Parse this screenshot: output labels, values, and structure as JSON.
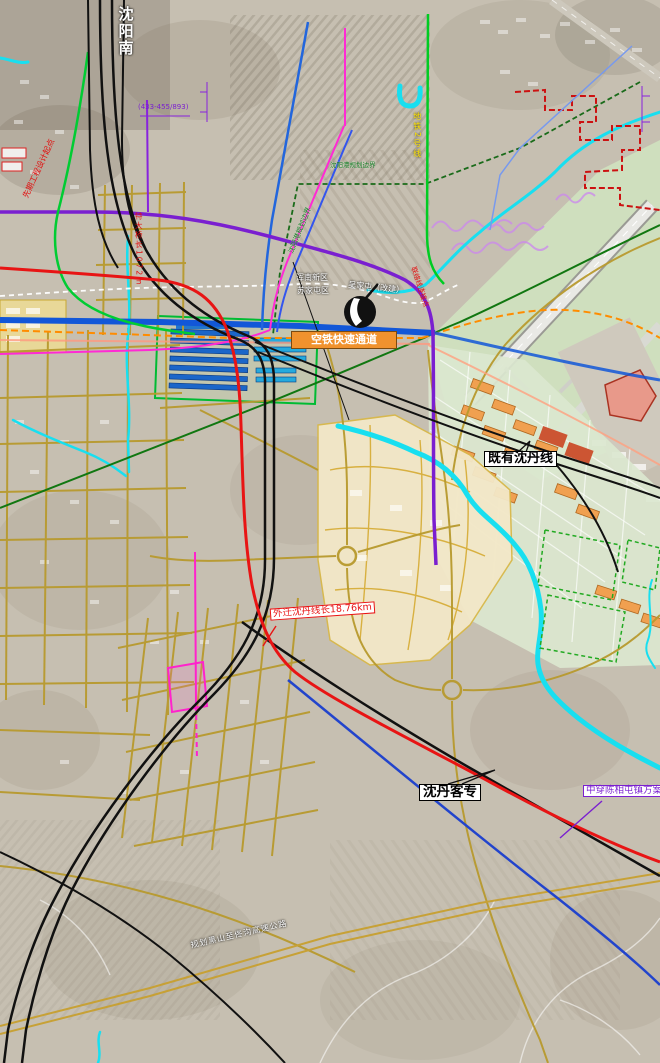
{
  "map_type": "railway-relocation-planning-map",
  "labels": {
    "shenyang_south": {
      "text": "沈阳南"
    },
    "chainage": {
      "text": "(433-455/893)"
    },
    "design_start": {
      "text": "先期工程设计起点"
    },
    "bridge": {
      "text": "特大桥长1072m"
    },
    "hunnan": {
      "text": "浑南新区"
    },
    "sujiatun": {
      "text": "苏家屯区"
    },
    "wujiatun": {
      "text": "吴家屯（改建）"
    },
    "port_boundary": {
      "text": "沈阳港规划边界"
    },
    "connector": {
      "text": "联络线连接点"
    },
    "air_rail": {
      "text": "空铁快速通道"
    },
    "metro": {
      "text": "地铁2号线"
    },
    "existing_line": {
      "text": "既有沈丹线"
    },
    "relocated_line": {
      "text": "外迁沈丹线长18.76km"
    },
    "passenger_line": {
      "text": "沈丹客专"
    },
    "chenxiangtun_plan": {
      "text": "中穿陈相屯镇方案"
    },
    "expressway": {
      "text": "规划黑山至佟沟高速公路"
    }
  },
  "colors": {
    "relocated_line_red": "#e81414",
    "passenger_line_black": "#111111",
    "plan_option_blue": "#2244cc",
    "purple_road": "#7a1fd0",
    "river_cyan": "#18dff0",
    "road_gold": "#c8a833",
    "metro_green": "#00cc22",
    "magenta_line": "#ff22cc",
    "air_rail_orange": "#f0922e",
    "boundary_green_dashed": "#1a6b1a",
    "airport_boundary_red": "#cc1111"
  }
}
